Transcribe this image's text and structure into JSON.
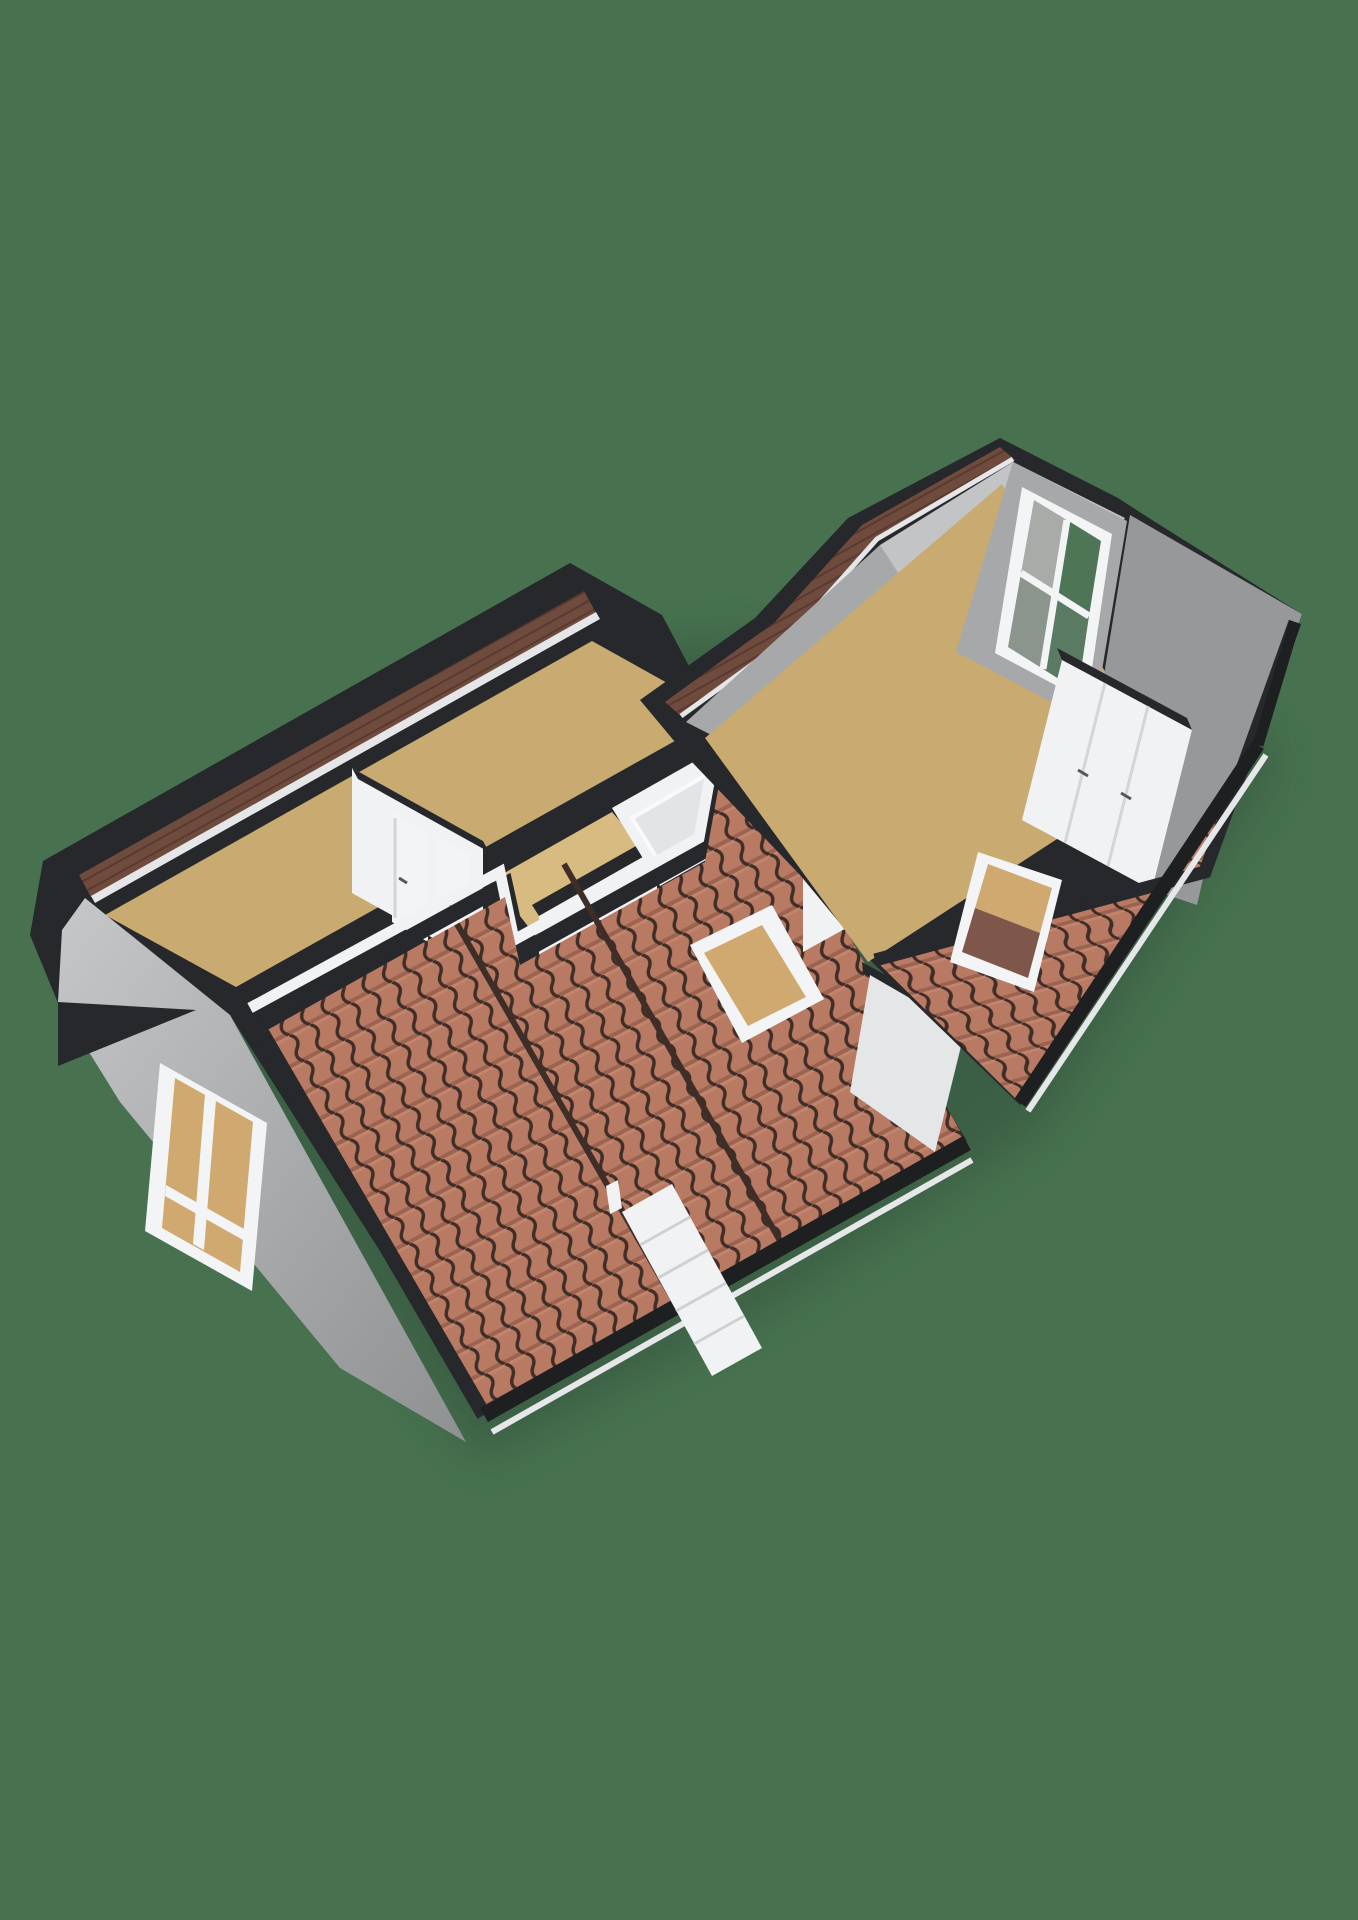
{
  "scene": {
    "title": "3d-floorplan-isometric-attic-floor",
    "view": "isometric-cutaway",
    "buildings": [
      "left-wing",
      "right-wing"
    ],
    "features": [
      "tiled-roof-slopes",
      "skylights",
      "gable-window",
      "attic-window",
      "closet-doors",
      "staircase",
      "interior-doors"
    ]
  },
  "colors": {
    "background": "#47714f",
    "shadow": "#2f4b37",
    "dark_trim": "#26282b",
    "dark_trim_deep": "#1d1f21",
    "wood_band": "#6f4b3e",
    "wood_line": "#5a3a30",
    "wall_white": "#f1f2f3",
    "wall_white_dim": "#e5e6e8",
    "wall_gray_light": "#c3c4c6",
    "wall_gray": "#a7a8aa",
    "wall_gray_dark": "#97989a",
    "floor_tan": "#c9ab72",
    "floor_tan_light": "#d8bb80",
    "tile_base": "#b87a63",
    "tile_line": "#3f2d27",
    "tile_shadow": "#84503f",
    "tile_highlight": "#c98d75",
    "glass_tan": "#cfa970",
    "glass_tan_dark": "#7e564a",
    "frame_white": "#f3f4f5",
    "gutter_white": "#e6e7e9",
    "pane_green": "#4e7656",
    "pane_gray": "#a9aba8",
    "pane_graygreen": "#5b7a64",
    "pane_gray2": "#8b948d"
  }
}
